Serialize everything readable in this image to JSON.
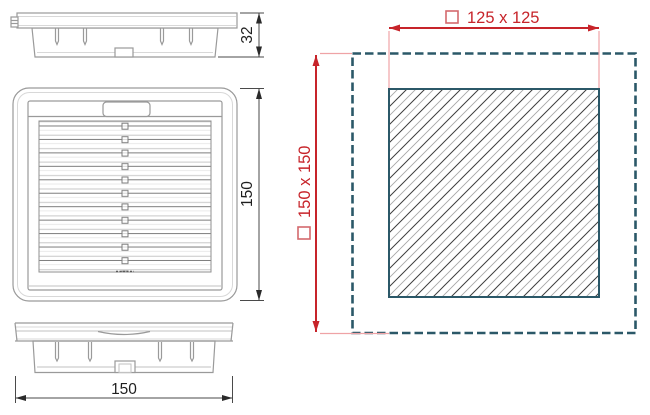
{
  "views": {
    "top_profile": {
      "depth_dimension": "32"
    },
    "front": {
      "height_dimension": "150",
      "louver_rows": 11
    },
    "bottom_profile": {
      "width_dimension": "150"
    },
    "mounting_cutout": {
      "square_symbol": "□",
      "cutout_dimension": "125 x 125",
      "overall_dimension": "150 x 150"
    }
  },
  "colors": {
    "dimension_red": "#c7242a",
    "extension_pink": "#efa3a6",
    "dashed_outline_teal": "#2b5868",
    "drawing_line_gray": "#9a9a9a",
    "dimension_line_gray": "#4a4a4a",
    "background": "#ffffff"
  }
}
